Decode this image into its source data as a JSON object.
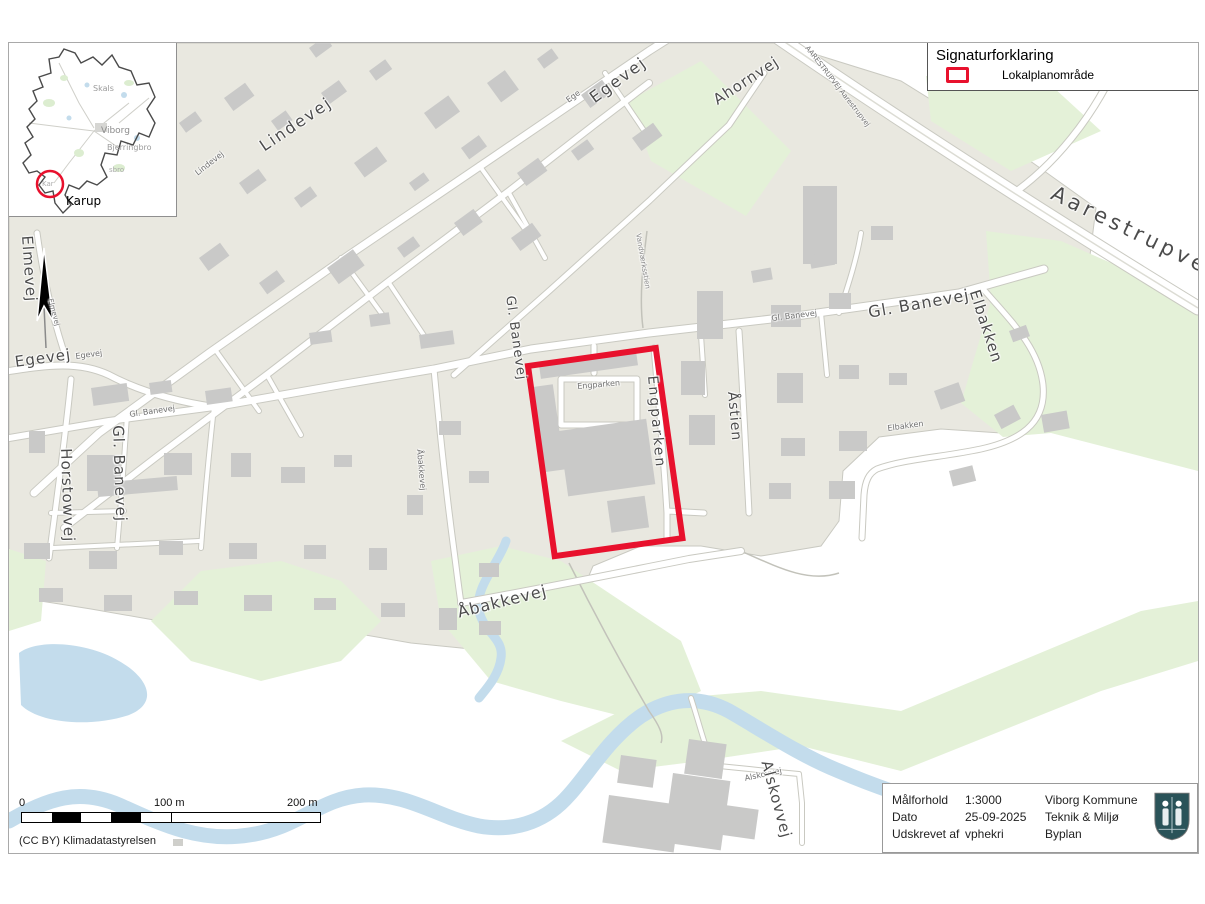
{
  "legend": {
    "title": "Signaturforklaring",
    "items": [
      {
        "label": "Lokalplanområde",
        "symbol": "red-rect-outline",
        "symbol_color": "#e8112d"
      }
    ]
  },
  "inset": {
    "towns": [
      {
        "text": "Skals",
        "x": 84,
        "y": 42,
        "size": 8,
        "color": "#9a9a9a"
      },
      {
        "text": "Viborg",
        "x": 92,
        "y": 84,
        "size": 9,
        "color": "#8c8c8c"
      },
      {
        "text": "Bjerringbro",
        "x": 98,
        "y": 101,
        "size": 8,
        "color": "#9a9a9a"
      },
      {
        "text": "sbro",
        "x": 100,
        "y": 124,
        "size": 7,
        "color": "#ababab"
      },
      {
        "text": "Kar",
        "x": 33,
        "y": 138,
        "size": 7,
        "color": "#ababab"
      },
      {
        "text": "Karup",
        "x": 57,
        "y": 152,
        "size": 12,
        "color": "#000000"
      }
    ],
    "highlight_circle_color": "#e8112d"
  },
  "map": {
    "street_labels": [
      {
        "text": "Lindevej",
        "x": 185,
        "y": 128,
        "rot": -38,
        "size": 8,
        "color": "#707070"
      },
      {
        "text": "Lindevej",
        "x": 248,
        "y": 98,
        "rot": -34,
        "size": 16,
        "ls": 2
      },
      {
        "text": "Ege",
        "x": 556,
        "y": 55,
        "rot": -36,
        "size": 8,
        "color": "#707070"
      },
      {
        "text": "Egevej",
        "x": 578,
        "y": 50,
        "rot": -36,
        "size": 16,
        "ls": 2
      },
      {
        "text": "Ahornvej",
        "x": 702,
        "y": 52,
        "rot": -33,
        "size": 15,
        "ls": 1
      },
      {
        "text": "AARESTRUPVEJ Aarestrupvej",
        "x": 800,
        "y": 2,
        "rot": 52,
        "size": 7,
        "color": "#707070"
      },
      {
        "text": "Aarestrupvej",
        "x": 1048,
        "y": 140,
        "rot": 26,
        "size": 21,
        "ls": 4
      },
      {
        "text": "Elmevej",
        "x": 25,
        "y": 192,
        "rot": 86,
        "size": 15,
        "ls": 1
      },
      {
        "text": "Elmevej",
        "x": 44,
        "y": 255,
        "rot": 75,
        "size": 7,
        "color": "#707070"
      },
      {
        "text": "Egevej",
        "x": 5,
        "y": 312,
        "rot": -8,
        "size": 15,
        "ls": 1
      },
      {
        "text": "Egevej",
        "x": 66,
        "y": 310,
        "rot": -8,
        "size": 8,
        "color": "#707070"
      },
      {
        "text": "Gl. Banevej",
        "x": 120,
        "y": 368,
        "rot": -8,
        "size": 8,
        "color": "#707070"
      },
      {
        "text": "Gl. Banevej",
        "x": 116,
        "y": 382,
        "rot": 88,
        "size": 15,
        "ls": 1
      },
      {
        "text": "Horstowvej",
        "x": 64,
        "y": 405,
        "rot": 88,
        "size": 15,
        "ls": 1
      },
      {
        "text": "Gl. Banevej",
        "x": 507,
        "y": 252,
        "rot": 82,
        "size": 13,
        "ls": 1
      },
      {
        "text": "Gl. Banevej",
        "x": 762,
        "y": 272,
        "rot": -7,
        "size": 8,
        "color": "#707070"
      },
      {
        "text": "Gl. Banevej",
        "x": 858,
        "y": 262,
        "rot": -10,
        "size": 16,
        "ls": 1
      },
      {
        "text": "Elbakken",
        "x": 972,
        "y": 245,
        "rot": 72,
        "size": 15,
        "ls": 1
      },
      {
        "text": "Elbakken",
        "x": 878,
        "y": 382,
        "rot": -8,
        "size": 8,
        "color": "#707070"
      },
      {
        "text": "Åstien",
        "x": 730,
        "y": 348,
        "rot": 85,
        "size": 14,
        "ls": 1
      },
      {
        "text": "Engparken",
        "x": 568,
        "y": 340,
        "rot": -5,
        "size": 8,
        "color": "#707070"
      },
      {
        "text": "Engparken",
        "x": 650,
        "y": 332,
        "rot": 85,
        "size": 14,
        "ls": 2
      },
      {
        "text": "Vandværksstien",
        "x": 632,
        "y": 190,
        "rot": 80,
        "size": 7,
        "color": "#8a8a8a"
      },
      {
        "text": "Åbakkevej",
        "x": 414,
        "y": 406,
        "rot": 85,
        "size": 8,
        "color": "#707070"
      },
      {
        "text": "Åbakkevej",
        "x": 447,
        "y": 562,
        "rot": -14,
        "size": 16,
        "ls": 1
      },
      {
        "text": "Alskovvej",
        "x": 735,
        "y": 732,
        "rot": -12,
        "size": 8,
        "color": "#707070"
      },
      {
        "text": "Alskovvej",
        "x": 764,
        "y": 716,
        "rot": 75,
        "size": 15,
        "ls": 1
      }
    ]
  },
  "scalebar": {
    "labels": [
      {
        "text": "0",
        "x": 0
      },
      {
        "text": "100 m",
        "x": 135
      },
      {
        "text": "200 m",
        "x": 268
      }
    ]
  },
  "attribution": "(CC BY) Klimadatastyrelsen",
  "infobox": {
    "rows": [
      {
        "label": "Målforhold",
        "value": "1:3000",
        "dept": "Viborg Kommune"
      },
      {
        "label": "Dato",
        "value": "25-09-2025",
        "dept": "Teknik & Miljø"
      },
      {
        "label": "Udskrevet af",
        "value": "vphekri",
        "dept": "Byplan"
      }
    ]
  },
  "colors": {
    "plan_area_red": "#e8112d",
    "urban_beige": "#e9e8e0",
    "building_gray": "#c9c9c8",
    "green_area": "#e4f1d8",
    "water_blue": "#c3dcec",
    "road_white": "#ffffff",
    "road_casing": "#c9c9c1",
    "crest_teal": "#2a5359"
  }
}
